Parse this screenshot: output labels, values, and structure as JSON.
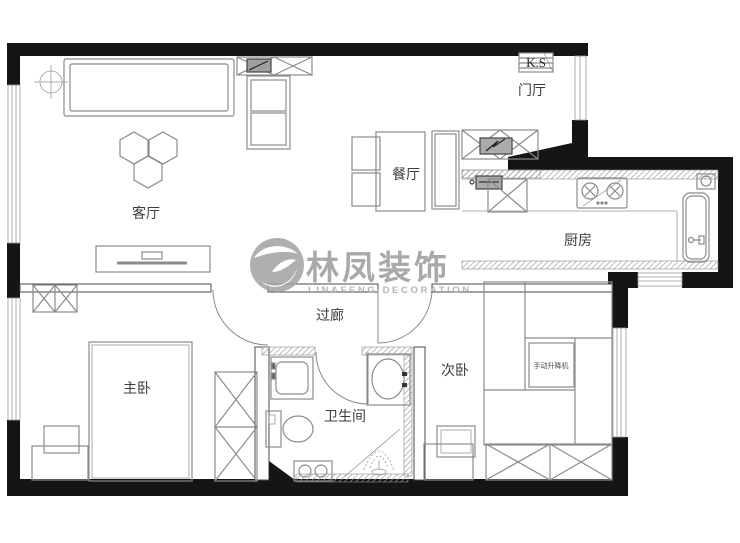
{
  "plan": {
    "watermark": {
      "name": "林凤装饰",
      "subtitle": "LIN&FENG DECORATION"
    },
    "rooms": {
      "living": "客厅",
      "entry": "门厅",
      "dining": "餐厅",
      "kitchen": "厨房",
      "corridor": "过廊",
      "master": "主卧",
      "bathroom": "卫生间",
      "second": "次卧"
    },
    "labels": {
      "ks": "K.S",
      "lift_table": "手动升降机"
    },
    "colors": {
      "wall": "#151515",
      "furniture_line": "#8b8b8b",
      "text": "#3c3c3c",
      "watermark": "#9b9b9b"
    }
  }
}
